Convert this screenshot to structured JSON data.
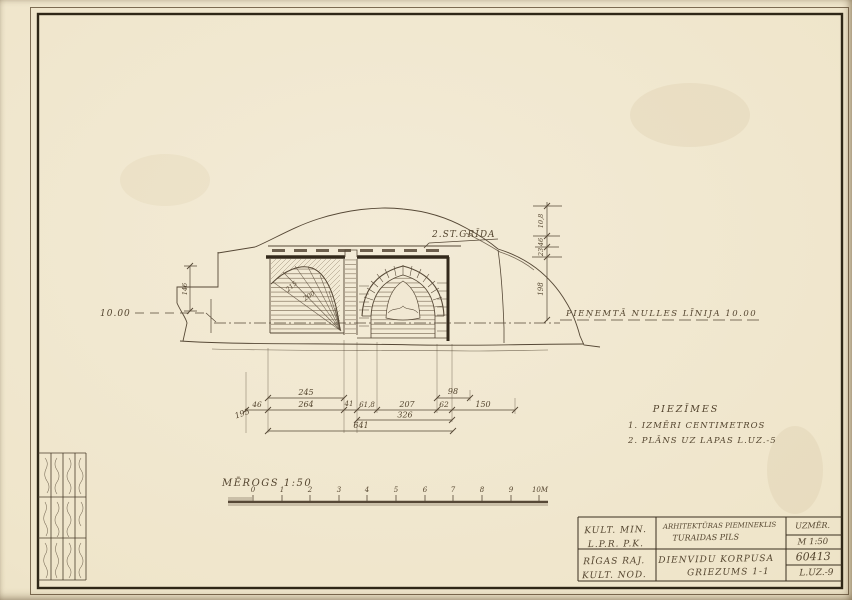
{
  "palette": {
    "paper": "#efe5ca",
    "ink": "#564836",
    "ink_heavy": "#33291b"
  },
  "drawing": {
    "floor_label": "2.ST.GRĪDA",
    "level_left": "10.00",
    "zero_line_label": "PIEŅEMTĀ NULLES LĪNIJA 10.00",
    "arch_radius_labels": [
      "215",
      "200"
    ],
    "left_height": "146"
  },
  "dims": {
    "h_top": [
      "245",
      "98"
    ],
    "h_mid": [
      "46",
      "264",
      "41",
      "61,8",
      "207",
      "62",
      "150"
    ],
    "h_low": "326",
    "h_left_diag": "195",
    "h_total": "641",
    "v_right": [
      "10,8",
      "46",
      "23",
      "198"
    ]
  },
  "notes": {
    "title": "PIEZĪMES",
    "lines": [
      "1. IZMĒRI CENTIMETROS",
      "2. PLĀNS UZ LAPAS L.UZ.-5"
    ]
  },
  "scale_bar": {
    "label": "MĒROGS 1:50",
    "ticks": [
      "0",
      "1",
      "2",
      "3",
      "4",
      "5",
      "6",
      "7",
      "8",
      "9",
      "10M"
    ]
  },
  "title_block": {
    "org_row1_line1": "KULT. MIN.",
    "org_row1_line2": "L.P.R. P.K.",
    "org_row2_line1": "RĪGAS RAJ.",
    "org_row2_line2": "KULT. NOD.",
    "monument_line1": "ARHITEKTŪRAS PIEMINEKLIS",
    "monument_line2": "TURAIDAS PILS",
    "drawing_line1": "DIENVIDU KORPUSA",
    "drawing_line2": "GRIEZUMS 1-1",
    "col3_row1": "UZMĒR.",
    "col3_row2": "M 1:50",
    "col3_row3": "60413",
    "col3_row4": "L.UZ.-9"
  }
}
